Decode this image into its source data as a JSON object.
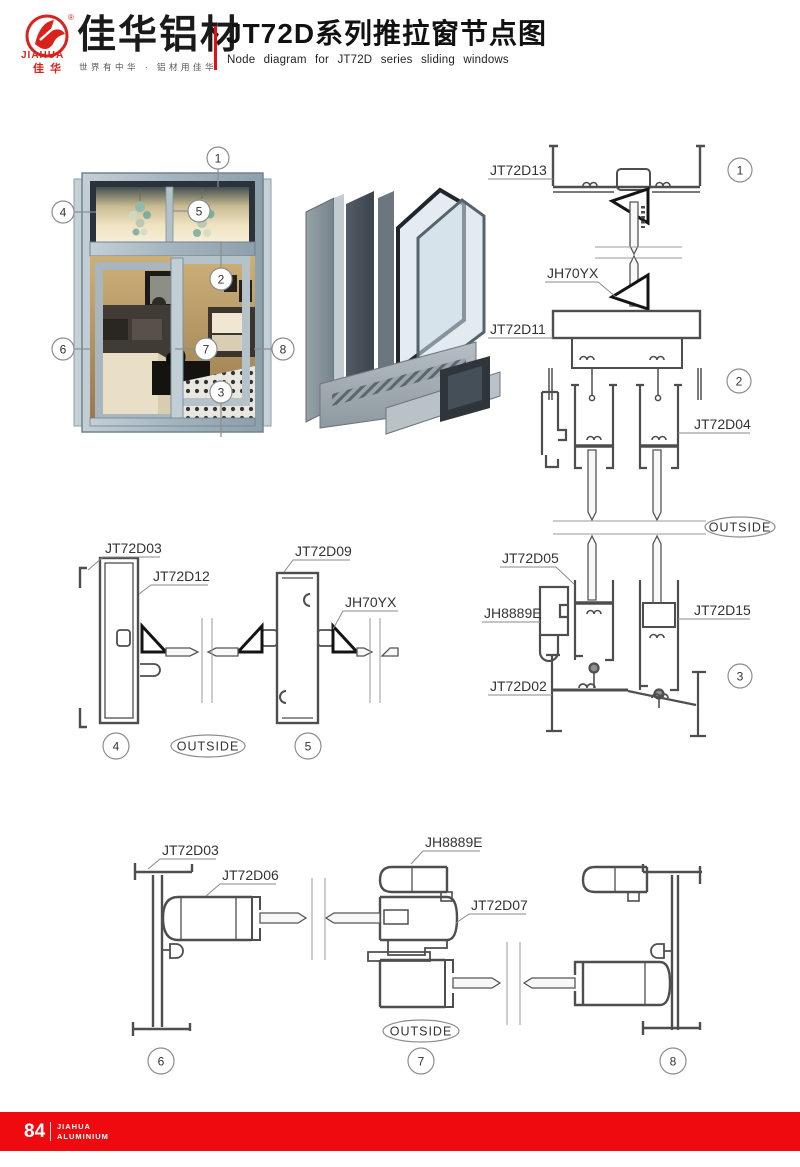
{
  "header": {
    "brand_en": "JIAHUA",
    "brand_cn": "佳华",
    "registered_mark": "®",
    "company_name": "佳华铝材",
    "tagline": "世界有中华 · 铝材用佳华",
    "title_cn": "JT72D系列推拉窗节点图",
    "title_en": "Node diagram for JT72D series sliding windows"
  },
  "parts": {
    "jt72d13": "JT72D13",
    "jh70yx_top": "JH70YX",
    "jt72d11": "JT72D11",
    "jt72d04": "JT72D04",
    "jt72d05": "JT72D05",
    "jh8889e_right": "JH8889E",
    "jt72d15": "JT72D15",
    "jt72d02": "JT72D02",
    "jt72d03_mid": "JT72D03",
    "jt72d12": "JT72D12",
    "jt72d09": "JT72D09",
    "jh70yx_mid": "JH70YX",
    "jt72d03_bottom": "JT72D03",
    "jt72d06": "JT72D06",
    "jh8889e_bottom": "JH8889E",
    "jt72d07": "JT72D07"
  },
  "callouts": {
    "c1": "1",
    "c2": "2",
    "c3": "3",
    "c4": "4",
    "c5": "5",
    "c6": "6",
    "c7": "7",
    "c8": "8"
  },
  "labels": {
    "outside": "OUTSIDE"
  },
  "footer": {
    "page_number": "84",
    "brand_line1": "JIAHUA",
    "brand_line2": "ALUMINIUM"
  },
  "colors": {
    "brand_red": "#e50e12",
    "footer_red": "#ee0a0e",
    "line_gray": "#4e4e4e",
    "leader_gray": "#8a8a8a",
    "steel_frame": "#aebfc9"
  }
}
